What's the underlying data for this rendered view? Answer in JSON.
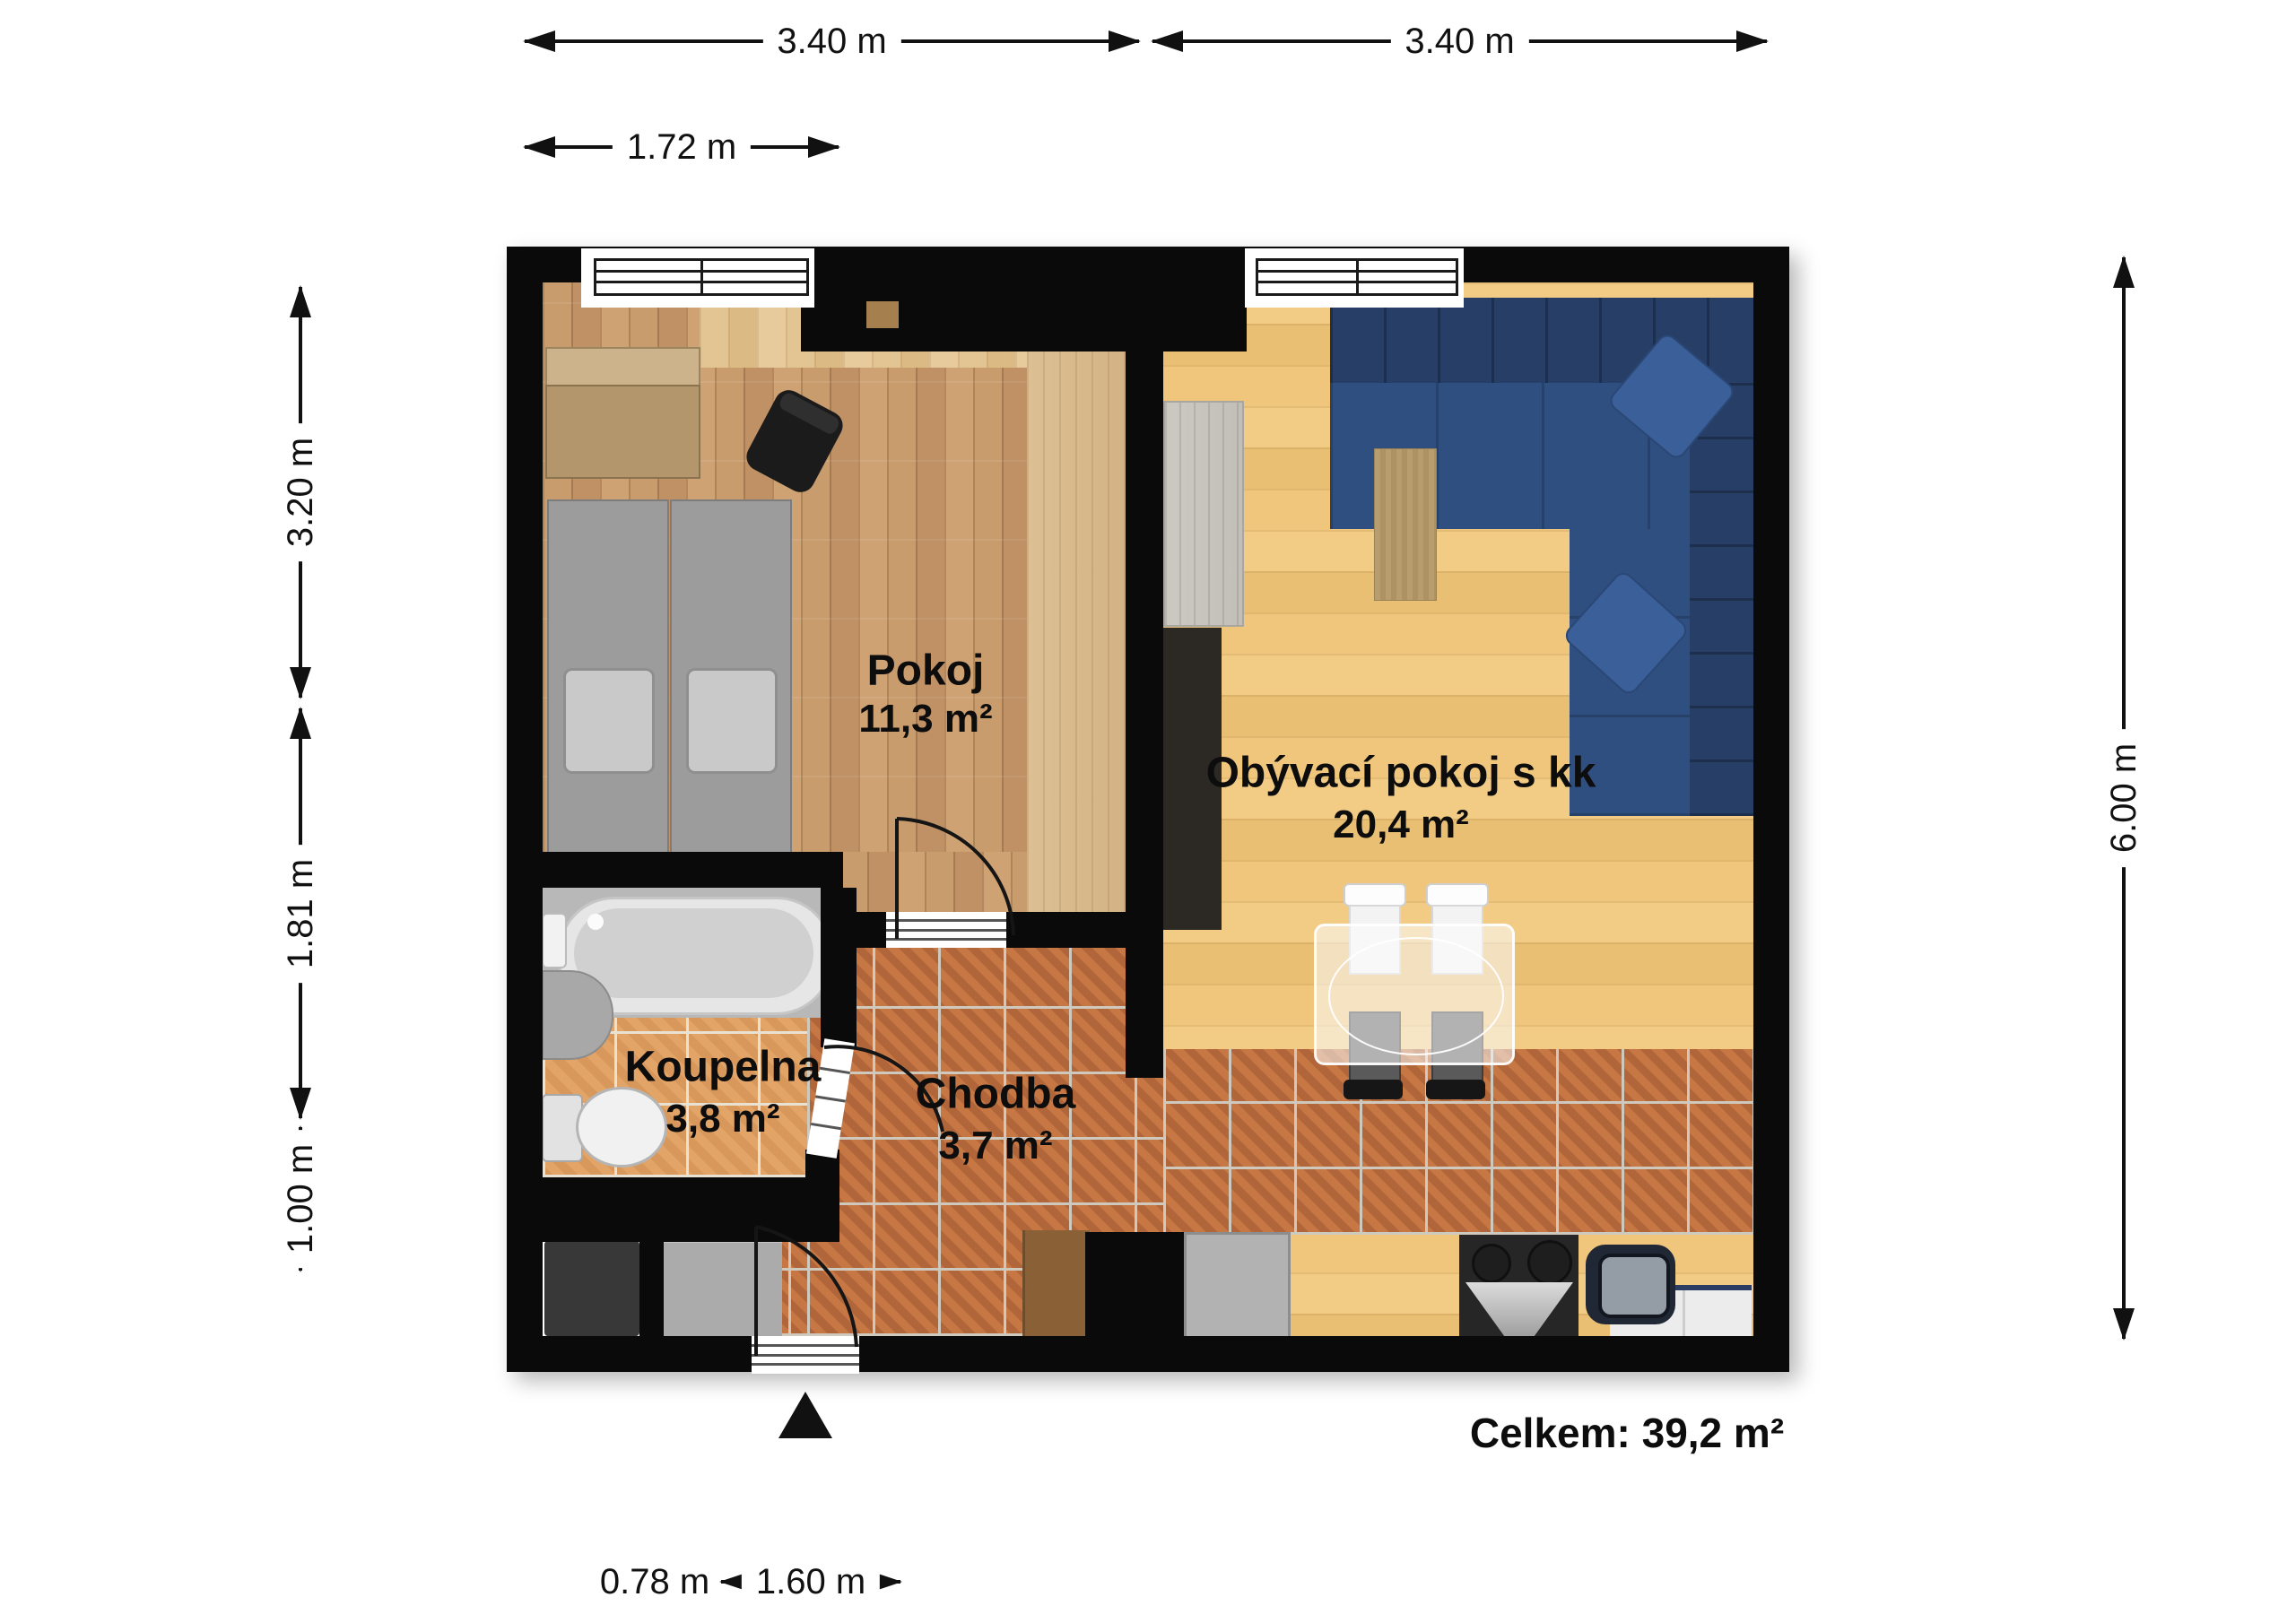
{
  "floorplan": {
    "rooms": [
      {
        "name": "Pokoj",
        "area": "11,3 m²"
      },
      {
        "name": "Obývací pokoj s kk",
        "area": "20,4 m²"
      },
      {
        "name": "Koupelna",
        "area": "3,8 m²"
      },
      {
        "name": "Chodba",
        "area": "3,7 m²"
      }
    ],
    "total_label": "Celkem: 39,2 m²",
    "dimensions": {
      "top_width_left": "3.40 m",
      "top_width_right": "3.40 m",
      "window_width": "1.72 m",
      "left_upper": "3.20 m",
      "left_middle": "1.81 m",
      "left_lower": "1.00 m",
      "right_height": "6.00 m",
      "bottom_nook": "0.78 m",
      "bottom_door": "1.60 m"
    },
    "colors": {
      "wall": "#0a0a0a",
      "bedroom_floor": "#c79a6b",
      "living_floor": "#eec67e",
      "hall_tile": "#c0713f",
      "bath_tile": "#de9f62",
      "sofa": "#2f4f80",
      "dimension_line": "#111111"
    }
  }
}
